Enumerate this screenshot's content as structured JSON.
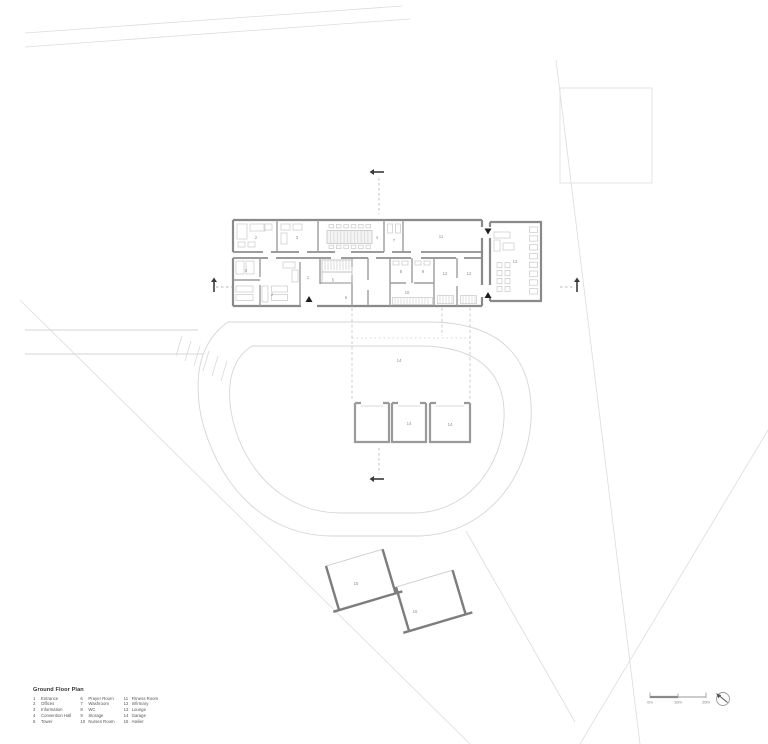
{
  "title": "Ground Floor Plan",
  "legend": {
    "col1": [
      {
        "num": "1",
        "label": "Entrance"
      },
      {
        "num": "2",
        "label": "Offices"
      },
      {
        "num": "3",
        "label": "Information"
      },
      {
        "num": "4",
        "label": "Convention Hall"
      },
      {
        "num": "5",
        "label": "Tower"
      }
    ],
    "col2": [
      {
        "num": "6",
        "label": "Prayer Room"
      },
      {
        "num": "7",
        "label": "Washroom"
      },
      {
        "num": "8",
        "label": "WC"
      },
      {
        "num": "9",
        "label": "Storage"
      },
      {
        "num": "10",
        "label": "Nurses Room"
      }
    ],
    "col3": [
      {
        "num": "11",
        "label": "Fitness Room"
      },
      {
        "num": "12",
        "label": "Infirmary"
      },
      {
        "num": "13",
        "label": "Lounge"
      },
      {
        "num": "14",
        "label": "Garage"
      },
      {
        "num": "15",
        "label": "Atelier"
      }
    ]
  },
  "rooms": {
    "r1": "1",
    "r2": "2",
    "r3": "3",
    "r2b": "2",
    "r3b": "3",
    "r4": "4",
    "r5": "5",
    "r6": "6",
    "r7": "7",
    "r8": "8",
    "r9": "9",
    "r10": "10",
    "r11": "11",
    "r12a": "12",
    "r12b": "12",
    "r13": "13",
    "r14": "14",
    "g14a": "14",
    "g14b": "14",
    "r15a": "15",
    "r15b": "15"
  },
  "scale_bar": {
    "labels": [
      "0m",
      "10m",
      "20m"
    ]
  },
  "colors": {
    "wall": "#8a8a8a",
    "partition": "#9c9c9c",
    "furniture": "#cfcfcf",
    "site": "#d9d9d9",
    "marker": "#333333"
  }
}
